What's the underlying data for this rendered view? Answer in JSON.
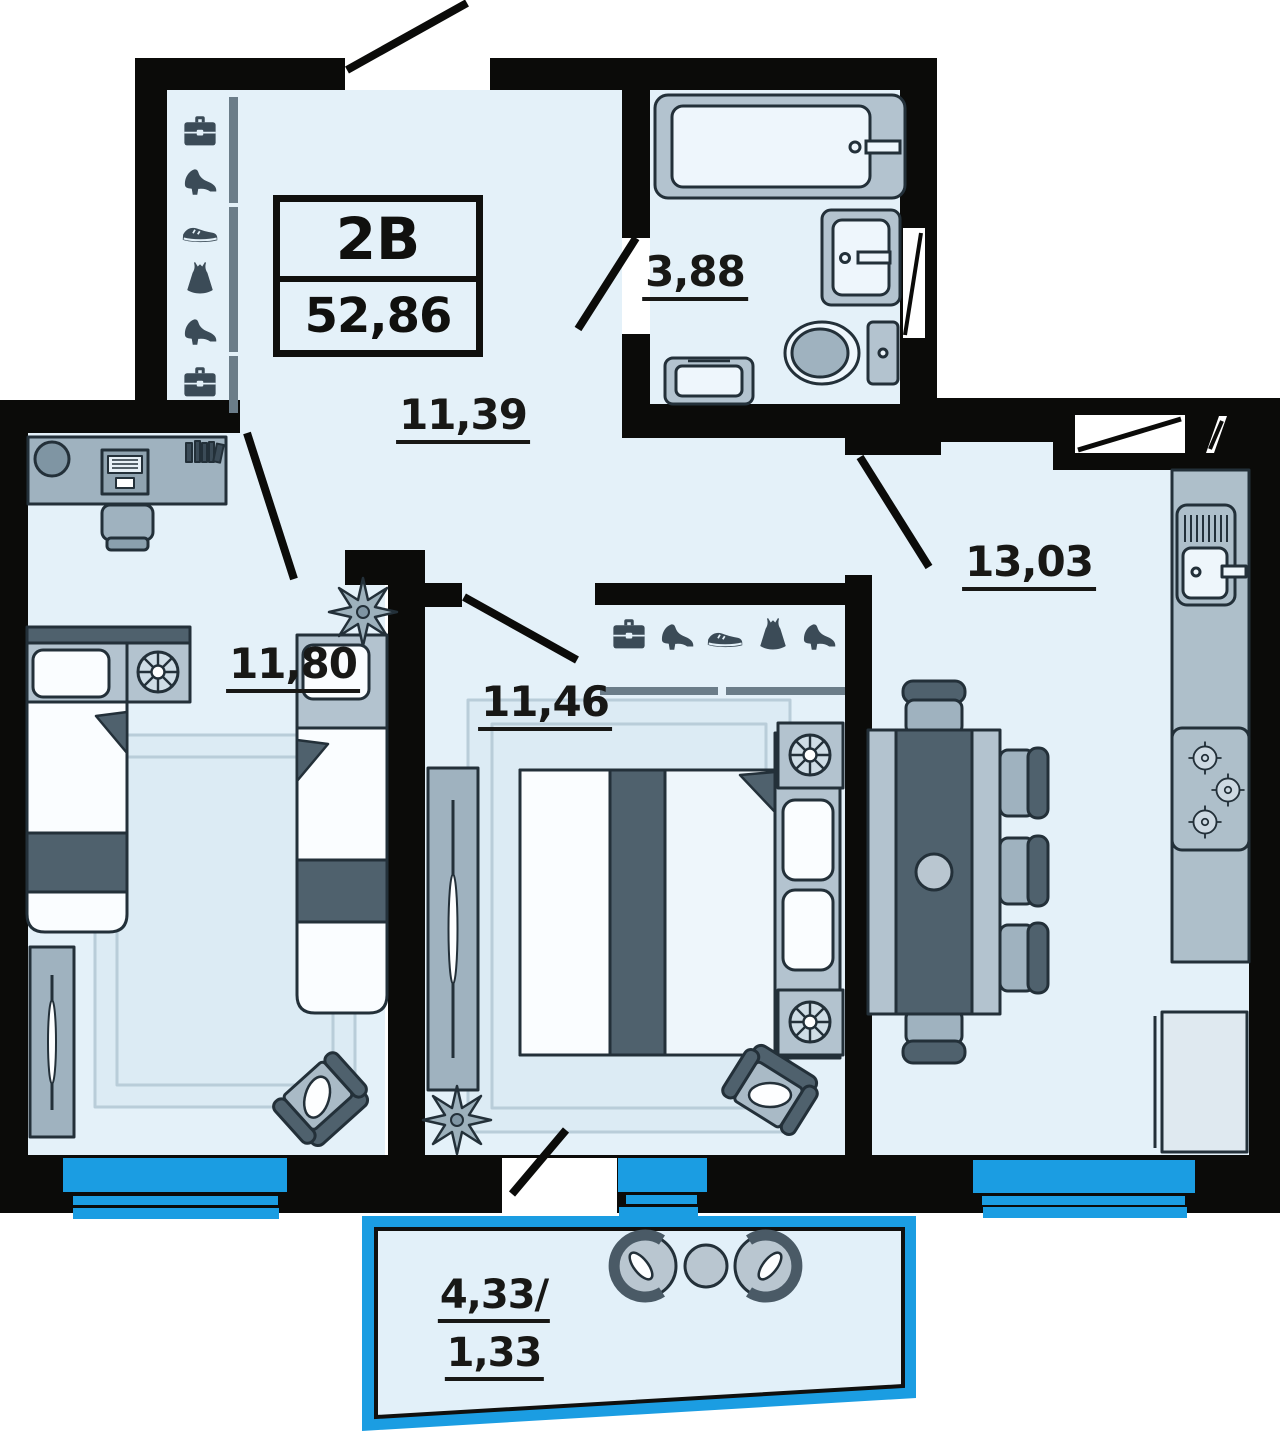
{
  "meta": {
    "kind": "apartment floor plan"
  },
  "title": {
    "unit_type": "2В",
    "total_area": "52,86"
  },
  "rooms": {
    "hallway": {
      "area": "11,39"
    },
    "bathroom": {
      "area": "3,88"
    },
    "kitchen": {
      "area": "13,03"
    },
    "bedroom1": {
      "area": "11,80"
    },
    "bedroom2": {
      "area": "11,46"
    },
    "balcony": {
      "area_full": "4,33/",
      "area_reduced": "1,33"
    }
  },
  "wardrobes": [
    {
      "slot_prefix": "hall",
      "icons": [
        "briefcase",
        "heel",
        "sneaker",
        "dress",
        "heel",
        "briefcase"
      ]
    },
    {
      "slot_prefix": "bed2",
      "icons": [
        "briefcase",
        "heel",
        "sneaker",
        "dress",
        "heel"
      ]
    }
  ],
  "colors": {
    "wall": "#0b0b09",
    "floor": "#e4f1f9",
    "window_blue": "#1b9de2",
    "furniture_dark": "#4f616d",
    "furniture_mid": "#9fb2bf",
    "furniture_light": "#b3c3cf",
    "outline": "#233039"
  }
}
